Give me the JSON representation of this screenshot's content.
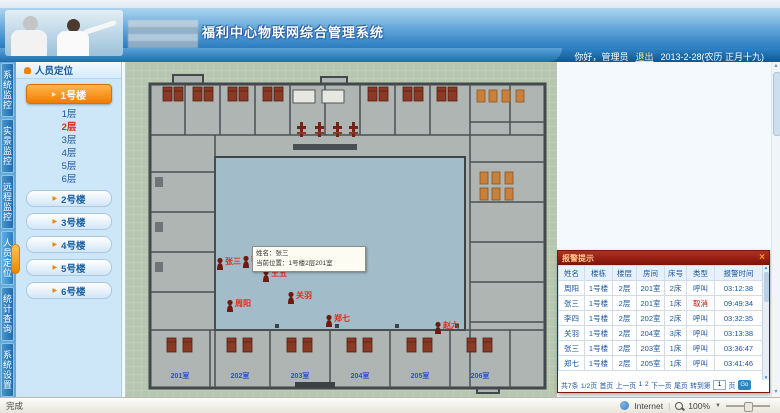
{
  "header": {
    "title": "福利中心物联网综合管理系统",
    "greeting": "你好，",
    "username": "管理员",
    "logout": "退出",
    "date": "2013-2-28(农历 正月十九)"
  },
  "nav_tabs": [
    {
      "label": "系统监控"
    },
    {
      "label": "实景监控"
    },
    {
      "label": "远程监控"
    },
    {
      "label": "人员定位"
    },
    {
      "label": "统计查询"
    },
    {
      "label": "系统设置"
    }
  ],
  "sidebar": {
    "panel_title": "人员定位",
    "active_building": "1号楼",
    "floors": [
      {
        "label": "1层"
      },
      {
        "label": "2层"
      },
      {
        "label": "3层"
      },
      {
        "label": "4层"
      },
      {
        "label": "5层"
      },
      {
        "label": "6层"
      }
    ],
    "buildings": [
      {
        "label": "2号楼"
      },
      {
        "label": "3号楼"
      },
      {
        "label": "4号楼"
      },
      {
        "label": "5号楼"
      },
      {
        "label": "6号楼"
      }
    ]
  },
  "map": {
    "tooltip": {
      "line1": "姓名：张三",
      "line2": "当前位置：1号楼2层201室"
    },
    "room_labels": [
      "201室",
      "202室",
      "203室",
      "204室",
      "205室",
      "206室"
    ],
    "markers": [
      {
        "name": "张三"
      },
      {
        "name": "李四"
      },
      {
        "name": "王五"
      },
      {
        "name": "周阳"
      },
      {
        "name": "关羽"
      },
      {
        "name": "郑七"
      },
      {
        "name": "赵六"
      }
    ]
  },
  "alarm_panel": {
    "title": "报警提示",
    "close": "×",
    "columns": [
      "姓名",
      "楼栋",
      "楼层",
      "房间",
      "床号",
      "类型",
      "报警时间"
    ],
    "rows": [
      [
        "周阳",
        "1号楼",
        "2层",
        "201室",
        "2床",
        "呼叫",
        "03:12:38"
      ],
      [
        "张三",
        "1号楼",
        "2层",
        "201室",
        "1床",
        "取消",
        "09:49:34"
      ],
      [
        "李四",
        "1号楼",
        "2层",
        "202室",
        "2床",
        "呼叫",
        "03:32:35"
      ],
      [
        "关羽",
        "1号楼",
        "2层",
        "204室",
        "3床",
        "呼叫",
        "03:13:38"
      ],
      [
        "张三",
        "1号楼",
        "2层",
        "203室",
        "1床",
        "呼叫",
        "03:36:47"
      ],
      [
        "郑七",
        "1号楼",
        "2层",
        "205室",
        "1床",
        "呼叫",
        "03:41:46"
      ]
    ],
    "pagination": {
      "total": "共7条",
      "page_info": "1/2页",
      "first": "首页",
      "prev": "上一页",
      "page1": "1",
      "page2": "2",
      "next": "下一页",
      "last": "尾页",
      "goto_label": "转到第",
      "goto_value": "1",
      "goto_unit": "页",
      "go": "Go"
    }
  },
  "statusbar": {
    "left": "完成",
    "zone": "Internet",
    "zoom": "100%"
  },
  "colors": {
    "accent_orange": "#f08200",
    "alarm_header_red": "#8b1a10",
    "active_floor_red": "#e02a1a",
    "link_blue": "#1a5fa0",
    "courtyard_blue": "#a2bcc9",
    "map_green": "#b7c6b1"
  }
}
